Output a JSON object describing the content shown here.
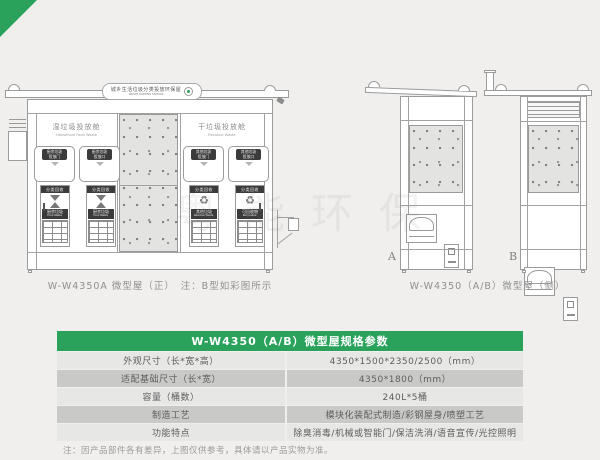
{
  "colors": {
    "accent_green": "#2aa25c",
    "page_bg": "#f0efed"
  },
  "icons": {
    "recycle": "♻"
  },
  "watermark_text": "粤能环保",
  "sign": {
    "title": "城乡生活垃圾分类投放环保屋",
    "subtitle": "WASTE SORTING STATION"
  },
  "front_view": {
    "caption": "W-W4350A 微型屋（正）　注：B型如彩图所示",
    "left_section": {
      "title": "湿垃圾投放舱",
      "subtitle": "Household Food Waste",
      "doors": [
        {
          "line1": "厨余垃圾",
          "line2": "投放门"
        },
        {
          "line1": "厨余垃圾",
          "line2": "投放口"
        }
      ],
      "cabinets": [
        {
          "header": "分类回收",
          "name": "厨余垃圾",
          "name_en": "Food Waste"
        },
        {
          "header": "分类回收",
          "name": "厨余垃圾",
          "name_en": "Food Waste"
        }
      ]
    },
    "right_section": {
      "title": "干垃圾投放舱",
      "subtitle": "Residual Waste",
      "doors": [
        {
          "line1": "其他垃圾",
          "line2": "投放门"
        },
        {
          "line1": "其他垃圾",
          "line2": "投放口"
        }
      ],
      "cabinets": [
        {
          "header": "分类回收",
          "name": "其他垃圾",
          "name_en": "Residual Waste"
        },
        {
          "header": "分类回收",
          "name": "可回收物",
          "name_en": "Recyclable"
        }
      ]
    }
  },
  "side_view": {
    "caption": "W-W4350（A/B）微型屋（侧）",
    "label_a": "A",
    "label_b": "B"
  },
  "spec_table": {
    "title": "W-W4350（A/B）微型屋规格参数",
    "rows": [
      {
        "label": "外观尺寸（长*宽*高）",
        "value": "4350*1500*2350/2500（mm）"
      },
      {
        "label": "适配基础尺寸（长*宽）",
        "value": "4350*1800（mm）"
      },
      {
        "label": "容量（桶数）",
        "value": "240L*5桶"
      },
      {
        "label": "制造工艺",
        "value": "模块化装配式制造/彩钢屋身/喷塑工艺"
      },
      {
        "label": "功能特点",
        "value": "除臭消毒/机械或智能门/保洁洗消/语音宣传/光控照明"
      }
    ]
  },
  "note": "注：因产品部件各有差异，上图仅供参考，具体请以产品实物为准。"
}
